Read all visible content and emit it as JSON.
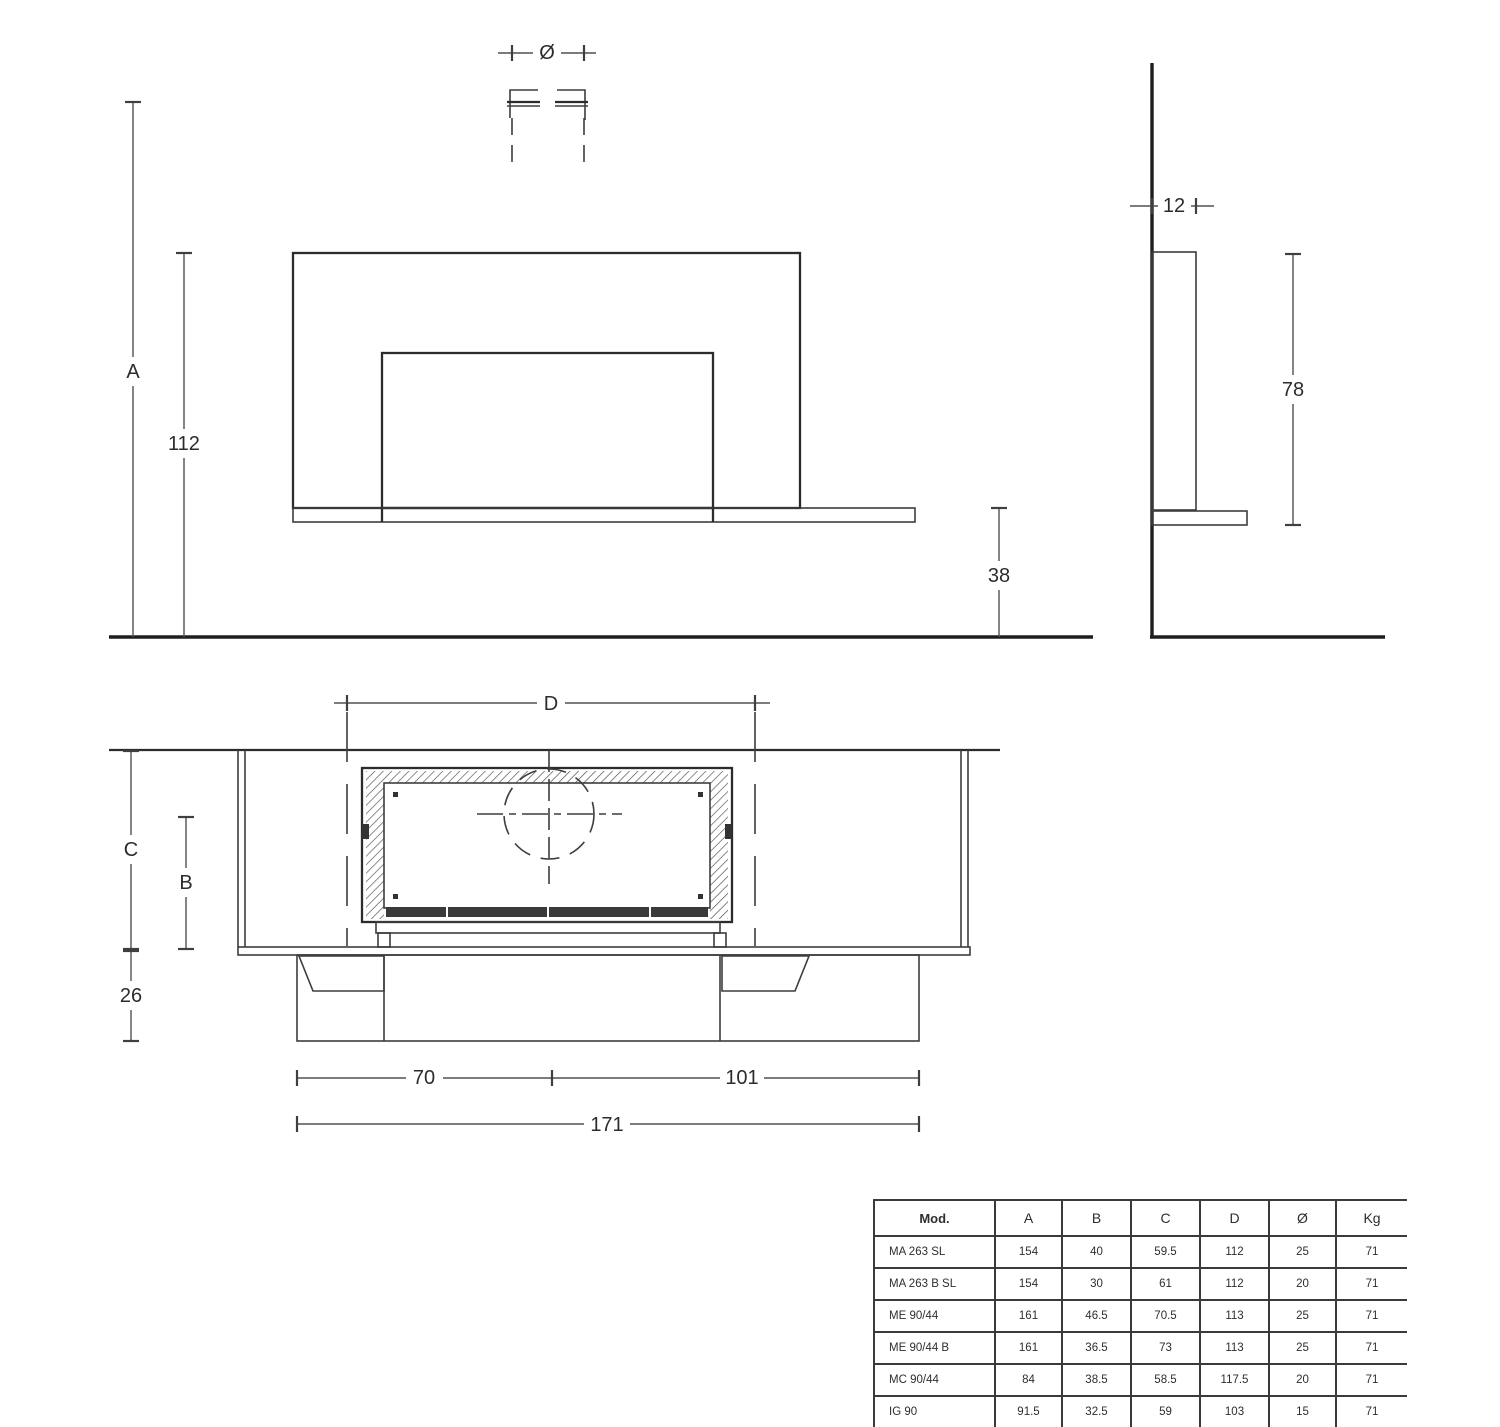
{
  "drawing": {
    "labels": {
      "diameter": "Ø",
      "a": "A",
      "h112": "112",
      "h38": "38",
      "d12": "12",
      "h78": "78",
      "d": "D",
      "c": "C",
      "b": "B",
      "h26": "26",
      "w70": "70",
      "w101": "101",
      "w171": "171"
    },
    "line_color": "#3d3d3d",
    "accent_fill": "#3a3a3a"
  },
  "table": {
    "headers": [
      "Mod.",
      "A",
      "B",
      "C",
      "D",
      "Ø",
      "Kg"
    ],
    "rows": [
      {
        "model": "MA 263 SL",
        "a": "154",
        "b": "40",
        "c": "59.5",
        "d": "112",
        "diam": "25",
        "kg": "71"
      },
      {
        "model": "MA 263 B SL",
        "a": "154",
        "b": "30",
        "c": "61",
        "d": "112",
        "diam": "20",
        "kg": "71"
      },
      {
        "model": "ME 90/44",
        "a": "161",
        "b": "46.5",
        "c": "70.5",
        "d": "113",
        "diam": "25",
        "kg": "71"
      },
      {
        "model": "ME 90/44 B",
        "a": "161",
        "b": "36.5",
        "c": "73",
        "d": "113",
        "diam": "25",
        "kg": "71"
      },
      {
        "model": "MC 90/44",
        "a": "84",
        "b": "38.5",
        "c": "58.5",
        "d": "117.5",
        "diam": "20",
        "kg": "71"
      },
      {
        "model": "IG 90",
        "a": "91.5",
        "b": "32.5",
        "c": "59",
        "d": "103",
        "diam": "15",
        "kg": "71"
      }
    ]
  }
}
